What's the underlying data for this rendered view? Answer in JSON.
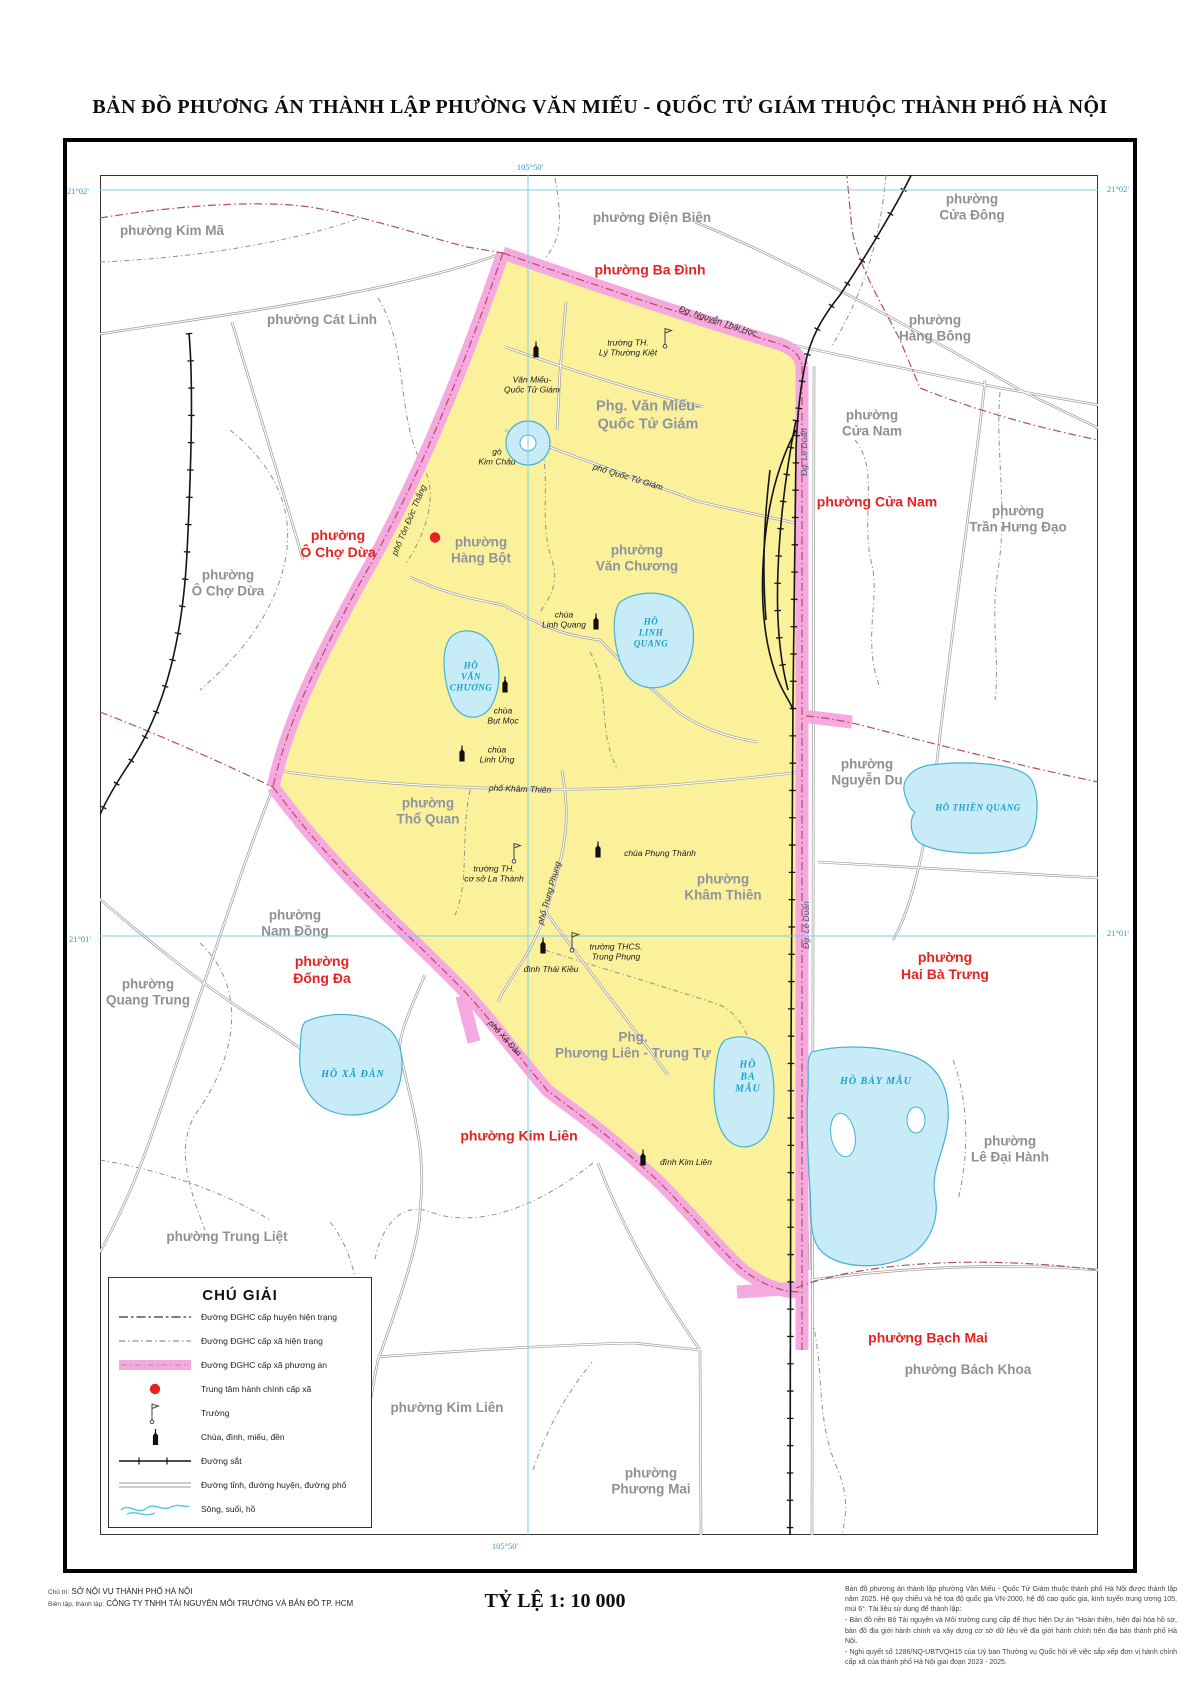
{
  "title": "BẢN ĐỒ  PHƯƠNG ÁN THÀNH LẬP PHƯỜNG VĂN MIẾU - QUỐC TỬ GIÁM THUỘC THÀNH PHỐ HÀ NỘI",
  "colors": {
    "pink": "#f6a8e0",
    "yellow": "#fbf19b",
    "lake": "#c8ecf7",
    "red_label": "#e62222",
    "gray_label": "#909090",
    "inner_label": "#8d94a0",
    "blue_label": "#18a0cc",
    "grid_line": "#7fcfe4",
    "grid_label": "#2d9cc5"
  },
  "map": {
    "labels": [
      {
        "text": "phường Ba Đình",
        "x": 650,
        "y": 270,
        "cls": "red",
        "name": "ward-label-ba-dinh"
      },
      {
        "text": "phường Cửa Nam",
        "x": 877,
        "y": 502,
        "cls": "red",
        "name": "ward-label-cua-nam-new"
      },
      {
        "text": "phường\nÔ Chợ Dừa",
        "x": 338,
        "y": 544,
        "cls": "red",
        "name": "ward-label-o-cho-dua-new"
      },
      {
        "text": "phường\nĐống Đa",
        "x": 322,
        "y": 970,
        "cls": "red",
        "name": "ward-label-dong-da"
      },
      {
        "text": "phường\nHai Bà Trưng",
        "x": 945,
        "y": 966,
        "cls": "red",
        "name": "ward-label-hai-ba-trung"
      },
      {
        "text": "phường Kim Liên",
        "x": 519,
        "y": 1136,
        "cls": "red",
        "name": "ward-label-kim-lien-new"
      },
      {
        "text": "phường Bạch Mai",
        "x": 928,
        "y": 1338,
        "cls": "red",
        "name": "ward-label-bach-mai"
      },
      {
        "text": "phường Kim Mã",
        "x": 172,
        "y": 231,
        "cls": "gray",
        "name": "ward-label-kim-ma"
      },
      {
        "text": "phường Cát Linh",
        "x": 322,
        "y": 320,
        "cls": "gray",
        "name": "ward-label-cat-linh"
      },
      {
        "text": "phường Điện Biên",
        "x": 652,
        "y": 218,
        "cls": "gray",
        "name": "ward-label-dien-bien"
      },
      {
        "text": "phường\nCửa Đông",
        "x": 972,
        "y": 208,
        "cls": "gray",
        "name": "ward-label-cua-dong"
      },
      {
        "text": "phường\nHàng Bông",
        "x": 935,
        "y": 329,
        "cls": "gray",
        "name": "ward-label-hang-bong"
      },
      {
        "text": "phường\nCửa Nam",
        "x": 872,
        "y": 424,
        "cls": "gray",
        "name": "ward-label-cua-nam-old"
      },
      {
        "text": "phường\nTrần Hưng Đạo",
        "x": 1018,
        "y": 520,
        "cls": "gray",
        "name": "ward-label-tran-hung-dao"
      },
      {
        "text": "phường\nÔ Chợ Dừa",
        "x": 228,
        "y": 584,
        "cls": "gray",
        "name": "ward-label-o-cho-dua-old"
      },
      {
        "text": "phường\nNguyễn Du",
        "x": 867,
        "y": 773,
        "cls": "gray",
        "name": "ward-label-nguyen-du"
      },
      {
        "text": "phường\nNam Đồng",
        "x": 295,
        "y": 924,
        "cls": "gray",
        "name": "ward-label-nam-dong"
      },
      {
        "text": "phường\nQuang Trung",
        "x": 148,
        "y": 993,
        "cls": "gray",
        "name": "ward-label-quang-trung"
      },
      {
        "text": "phường Trung Liệt",
        "x": 227,
        "y": 1237,
        "cls": "gray",
        "name": "ward-label-trung-liet"
      },
      {
        "text": "phường Kim Liên",
        "x": 447,
        "y": 1408,
        "cls": "gray",
        "name": "ward-label-kim-lien-old"
      },
      {
        "text": "phường\nPhương Mai",
        "x": 651,
        "y": 1482,
        "cls": "gray",
        "name": "ward-label-phuong-mai"
      },
      {
        "text": "phường\nLê Đại Hành",
        "x": 1010,
        "y": 1150,
        "cls": "gray",
        "name": "ward-label-le-dai-hanh"
      },
      {
        "text": "phường Bách Khoa",
        "x": 968,
        "y": 1370,
        "cls": "gray",
        "name": "ward-label-bach-khoa"
      },
      {
        "text": "Phg. Văn Miếu-\nQuốc Tử Giám",
        "x": 648,
        "y": 416,
        "cls": "wardin big",
        "name": "ward-label-van-mieu-qtg"
      },
      {
        "text": "phường\nHàng Bột",
        "x": 481,
        "y": 551,
        "cls": "wardin",
        "name": "ward-label-hang-bot"
      },
      {
        "text": "phường\nVăn Chương",
        "x": 637,
        "y": 559,
        "cls": "wardin",
        "name": "ward-label-van-chuong"
      },
      {
        "text": "phường\nThổ Quan",
        "x": 428,
        "y": 812,
        "cls": "wardin",
        "name": "ward-label-tho-quan"
      },
      {
        "text": "phường\nKhâm Thiên",
        "x": 723,
        "y": 888,
        "cls": "wardin",
        "name": "ward-label-kham-thien"
      },
      {
        "text": "Phg.\nPhương Liên - Trung Tự",
        "x": 633,
        "y": 1046,
        "cls": "wardin",
        "name": "ward-label-phuong-lien-trung-tu"
      },
      {
        "text": "HỒ\nLINH\nQUANG",
        "x": 651,
        "y": 633,
        "cls": "lakesm",
        "name": "lake-label-linh-quang"
      },
      {
        "text": "HỒ\nVĂN\nCHƯƠNG",
        "x": 471,
        "y": 677,
        "cls": "lakesm",
        "name": "lake-label-van-chuong"
      },
      {
        "text": "HỒ THIỀN QUANG",
        "x": 978,
        "y": 808,
        "cls": "lakesm",
        "name": "lake-label-thien-quang"
      },
      {
        "text": "HỒ XÃ ĐÀN",
        "x": 353,
        "y": 1075,
        "cls": "lake",
        "name": "lake-label-xa-dan"
      },
      {
        "text": "HỒ\nBA\nMẪU",
        "x": 748,
        "y": 1078,
        "cls": "lake",
        "name": "lake-label-ba-mau"
      },
      {
        "text": "HỒ BẢY MẪU",
        "x": 876,
        "y": 1082,
        "cls": "lake",
        "name": "lake-label-bay-mau"
      },
      {
        "text": "Văn Miếu-\nQuốc Tử Giám",
        "x": 532,
        "y": 385,
        "cls": "poi",
        "name": "poi-label-van-mieu"
      },
      {
        "text": "gò\nKim Châu",
        "x": 497,
        "y": 457,
        "cls": "poi",
        "name": "poi-label-go-kim-chau"
      },
      {
        "text": "trường TH.\nLý Thường Kiệt",
        "x": 628,
        "y": 348,
        "cls": "poi",
        "name": "poi-label-truong-ly-thuong-kiet"
      },
      {
        "text": "chùa\nLinh Quang",
        "x": 564,
        "y": 620,
        "cls": "poi",
        "name": "poi-label-chua-linh-quang"
      },
      {
        "text": "chùa\nBụt Mọc",
        "x": 503,
        "y": 716,
        "cls": "poi",
        "name": "poi-label-chua-but-moc"
      },
      {
        "text": "chùa\nLinh Ứng",
        "x": 497,
        "y": 755,
        "cls": "poi",
        "name": "poi-label-chua-linh-ung"
      },
      {
        "text": "chùa Phụng Thánh",
        "x": 660,
        "y": 853,
        "cls": "poi",
        "name": "poi-label-chua-phung-thanh"
      },
      {
        "text": "trường TH.\ncơ sở La Thành",
        "x": 494,
        "y": 874,
        "cls": "poi",
        "name": "poi-label-truong-la-thanh"
      },
      {
        "text": "đình Thái Kiều",
        "x": 551,
        "y": 969,
        "cls": "poi",
        "name": "poi-label-dinh-thai-kieu"
      },
      {
        "text": "trường THCS.\nTrung Phụng",
        "x": 616,
        "y": 952,
        "cls": "poi",
        "name": "poi-label-truong-trung-phung"
      },
      {
        "text": "đình Kim Liên",
        "x": 686,
        "y": 1162,
        "cls": "poi",
        "name": "poi-label-dinh-kim-lien"
      },
      {
        "text": "Đg. Nguyễn Thái Học",
        "x": 718,
        "y": 321,
        "cls": "road",
        "rot": 18,
        "name": "road-label-nguyen-thai-hoc"
      },
      {
        "text": "phố Quốc Tử Giám",
        "x": 628,
        "y": 477,
        "cls": "road",
        "rot": 17,
        "name": "road-label-quoc-tu-giam"
      },
      {
        "text": "phố Tôn Đức Thắng",
        "x": 409,
        "y": 520,
        "cls": "road",
        "rot": -67,
        "name": "road-label-ton-duc-thang"
      },
      {
        "text": "Đg. Lê Duẩn",
        "x": 804,
        "y": 452,
        "cls": "roadblue",
        "rot": -90,
        "name": "road-label-le-duan-1"
      },
      {
        "text": "Đg. Lê Duẩn",
        "x": 806,
        "y": 925,
        "cls": "roadblue",
        "rot": -90,
        "name": "road-label-le-duan-2"
      },
      {
        "text": "phố Khâm Thiên",
        "x": 520,
        "y": 789,
        "cls": "road",
        "rot": 2,
        "name": "road-label-kham-thien"
      },
      {
        "text": "phố Trung Phụng",
        "x": 549,
        "y": 893,
        "cls": "road",
        "rot": -74,
        "name": "road-label-trung-phung"
      },
      {
        "text": "phố Xã Đàn",
        "x": 505,
        "y": 1038,
        "cls": "road",
        "rot": 48,
        "name": "road-label-xa-dan"
      },
      {
        "text": "105°50'",
        "x": 530,
        "y": 167,
        "cls": "grid",
        "name": "grid-label-105-50-top"
      },
      {
        "text": "105°50'",
        "x": 505,
        "y": 1546,
        "cls": "grid",
        "name": "grid-label-105-50-bottom"
      },
      {
        "text": "21°02'",
        "x": 78,
        "y": 191,
        "cls": "grid",
        "name": "grid-label-21-02-left"
      },
      {
        "text": "21°02'",
        "x": 1118,
        "y": 189,
        "cls": "grid",
        "name": "grid-label-21-02-right"
      },
      {
        "text": "21°01'",
        "x": 80,
        "y": 939,
        "cls": "grid",
        "name": "grid-label-21-01-left"
      },
      {
        "text": "21°01'",
        "x": 1118,
        "y": 933,
        "cls": "grid",
        "name": "grid-label-21-01-right"
      }
    ],
    "icons": [
      {
        "type": "temple",
        "x": 536,
        "y": 352,
        "name": "temple-icon-van-mieu"
      },
      {
        "type": "temple",
        "x": 596,
        "y": 624,
        "name": "temple-icon-linh-quang"
      },
      {
        "type": "temple",
        "x": 505,
        "y": 687,
        "name": "temple-icon-but-moc"
      },
      {
        "type": "temple",
        "x": 462,
        "y": 756,
        "name": "temple-icon-linh-ung"
      },
      {
        "type": "temple",
        "x": 598,
        "y": 852,
        "name": "temple-icon-phung-thanh"
      },
      {
        "type": "temple",
        "x": 543,
        "y": 948,
        "name": "temple-icon-thai-kieu"
      },
      {
        "type": "temple",
        "x": 643,
        "y": 1160,
        "name": "temple-icon-kim-lien"
      },
      {
        "type": "flag",
        "x": 668,
        "y": 340,
        "name": "school-icon-ly-thuong-kiet"
      },
      {
        "type": "flag",
        "x": 517,
        "y": 855,
        "name": "school-icon-la-thanh"
      },
      {
        "type": "flag",
        "x": 575,
        "y": 944,
        "name": "school-icon-trung-phung"
      },
      {
        "type": "dot",
        "x": 435,
        "y": 540,
        "name": "admin-center-dot"
      }
    ]
  },
  "legend": {
    "title": "CHÚ GIẢI",
    "items": [
      {
        "sym": "line-huyen",
        "label": "Đường ĐGHC cấp huyện hiện trạng"
      },
      {
        "sym": "line-xa",
        "label": "Đường ĐGHC cấp xã hiện trạng"
      },
      {
        "sym": "band",
        "label": "Đường ĐGHC cấp xã phương án"
      },
      {
        "sym": "dot",
        "label": "Trung tâm hành chính cấp xã"
      },
      {
        "sym": "flag",
        "label": "Trường"
      },
      {
        "sym": "temple",
        "label": "Chùa, đình, miếu, đền"
      },
      {
        "sym": "rail",
        "label": "Đường sắt"
      },
      {
        "sym": "road",
        "label": "Đường tỉnh, đường huyện, đường phố"
      },
      {
        "sym": "river",
        "label": "Sông, suối, hồ"
      }
    ]
  },
  "footer": {
    "credit1_prefix": "Chủ trì:",
    "credit1": "SỞ NỘI VỤ THÀNH PHỐ HÀ NỘI",
    "credit2_prefix": "Biên tập, thành lập:",
    "credit2": "CÔNG TY TNHH TÀI NGUYÊN MÔI TRƯỜNG VÀ BẢN ĐỒ TP. HCM",
    "scale": "TỶ LỆ 1: 10 000",
    "notes": [
      "Bản đồ phương án thành lập phường Văn Miếu - Quốc Tử Giám thuộc thành phố Hà Nội được thành lập năm 2025. Hệ quy chiếu và hệ tọa độ quốc gia VN-2000, hệ độ cao quốc gia, kinh tuyến trung ương 105, múi 6°. Tài liệu sử dụng để thành lập:",
      "- Bản đồ nền Bộ Tài nguyên và Môi trường cung cấp để thực hiện Dự án \"Hoàn thiện, hiện đại hóa hồ sơ, bản đồ địa giới hành chính và xây dựng cơ sở dữ liệu về địa giới hành chính trên địa bàn thành phố Hà Nội.",
      "- Nghị quyết số 1286/NQ-UBTVQH15 của Uỷ ban Thường vụ Quốc hội về việc sắp xếp đơn vị hành chính cấp xã của thành phố Hà Nội giai đoạn 2023 - 2025."
    ]
  }
}
